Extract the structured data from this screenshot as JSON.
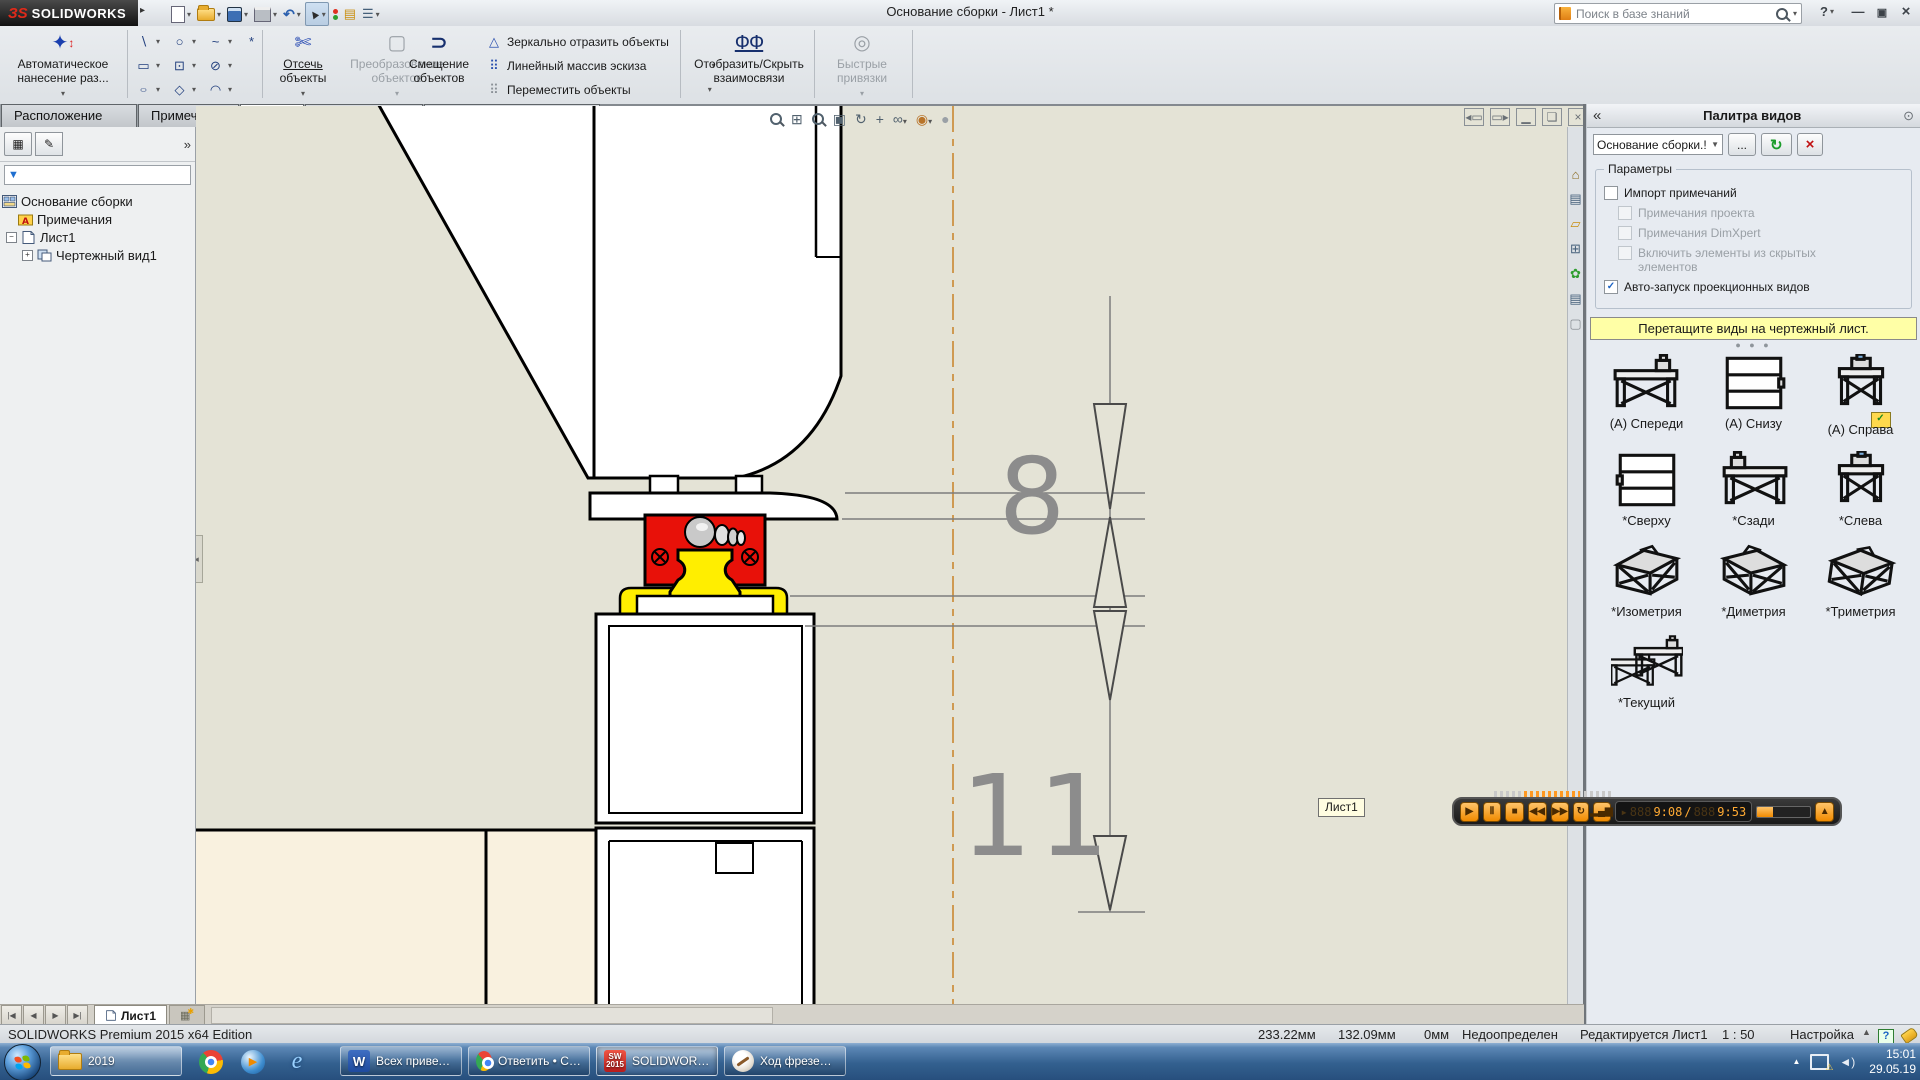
{
  "titlebar": {
    "brand_glyph": "ЗS",
    "brand_rest": "SOLIDWORKS",
    "title": "Основание сборки - Лист1 *",
    "search_placeholder": "Поиск в базе знаний",
    "help_glyph": "?"
  },
  "tabs": {
    "t0": "Расположение вида",
    "t1": "Примечание",
    "t2": "Эскиз",
    "t3": "Анализировать",
    "t4": "Добавления SOLIDWORKS"
  },
  "ribbon": {
    "auto_dim": {
      "l1": "Автоматическое",
      "l2": "нанесение раз..."
    },
    "trim": {
      "l1": "Отсечь",
      "l2": "объекты"
    },
    "convert": {
      "l1": "Преобразование",
      "l2": "объектов"
    },
    "offset": {
      "l1": "Смещение",
      "l2": "объектов"
    },
    "mirror": "Зеркально отразить объекты",
    "linear_pattern": "Линейный массив эскиза",
    "move": "Переместить объекты",
    "show_relations": {
      "l1": "Отобразить/Скрыть",
      "l2": "взаимосвязи"
    },
    "quick_snaps": {
      "l1": "Быстрые",
      "l2": "привязки"
    }
  },
  "tree": {
    "root": "Основание сборки",
    "notes": "Примечания",
    "sheet": "Лист1",
    "view": "Чертежный вид1"
  },
  "palette": {
    "header": "Палитра видов",
    "combo": "Основание сборки.!",
    "more": "...",
    "params": "Параметры",
    "chk_import": "Импорт примечаний",
    "chk_proj": "Примечания проекта",
    "chk_dimx": "Примечания DimXpert",
    "chk_hidden": "Включить элементы из скрытых элементов",
    "chk_auto": "Авто-запуск проекционных видов",
    "banner": "Перетащите виды на чертежный лист.",
    "v0": "(A) Спереди",
    "v1": "(A) Снизу",
    "v2": "(A) Справа",
    "v3": "*Сверху",
    "v4": "*Сзади",
    "v5": "*Слева",
    "v6": "*Изометрия",
    "v7": "*Диметрия",
    "v8": "*Триметрия",
    "v9": "*Текущий"
  },
  "drawing": {
    "dim_8": "8",
    "dim_11": "11",
    "tooltip": "Лист1"
  },
  "recorder": {
    "ghost": "888",
    "t1": "9:08",
    "sep": "/",
    "t2": "9:53"
  },
  "sheetbar": {
    "tab": "Лист1"
  },
  "status": {
    "left": "SOLIDWORKS Premium 2015 x64 Edition",
    "x": "233.22мм",
    "y": "132.09мм",
    "z": "0мм",
    "state": "Недоопределен",
    "editing": "Редактируется Лист1",
    "scale": "1 : 50",
    "config": "Настройка",
    "help": "?"
  },
  "taskbar": {
    "b_folder": "2019",
    "b_word": "Всех приветству...",
    "b_chrome": "Ответить • Станк...",
    "b_sw": "SOLIDWORKS Pre...",
    "b_paint": "Ход фрезера.png...",
    "time": "15:01",
    "date": "29.05.19"
  },
  "colors": {
    "accent_red": "#e81109",
    "accent_yellow": "#ffee00",
    "centerline": "#cf9a52",
    "banner_yellow": "#ffffa6",
    "taskbar_blue": "#33608f",
    "recorder_orange": "#f08a00"
  }
}
